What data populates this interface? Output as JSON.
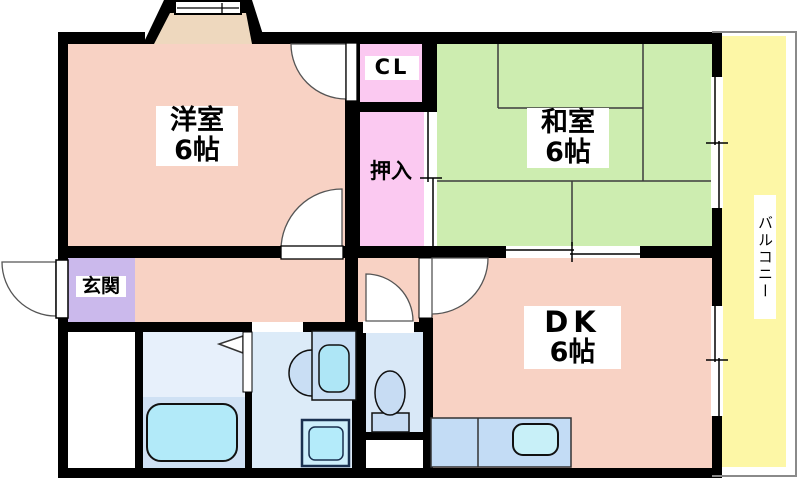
{
  "plan_title": "1DK apartment floor plan",
  "rooms": {
    "western": {
      "name": "洋室",
      "size": "6帖"
    },
    "japanese": {
      "name": "和室",
      "size": "6帖"
    },
    "dk": {
      "name": "DK",
      "size": "6帖"
    },
    "closet": {
      "label": "CL"
    },
    "oshiire": {
      "label": "押入"
    },
    "entrance": {
      "label": "玄関"
    },
    "balcony": {
      "label": "バルコニー"
    }
  },
  "fixtures": [
    "bathtub-icon",
    "toilet-icon",
    "washbasin-icon",
    "washing-machine-pan-icon",
    "kitchen-sink-icon",
    "bay-window-icon",
    "sliding-window-icon",
    "door-swing-icon"
  ],
  "colors": {
    "wall": "#000000",
    "room_salmon": "#f8d2c4",
    "closet_pink": "#fbc9f1",
    "tatami_green": "#cdedb0",
    "balcony_yellow": "#fdf7a6",
    "entrance_lavender": "#cbb9ec",
    "bath_floor": "#e7f0fb",
    "bath_unit": "#cfe1f4",
    "washroom_blue": "#dcebf8",
    "toilet_blue": "#d9e8f7",
    "fixture_blue": "#c9def4",
    "water_cyan": "#aee8f8",
    "bay_window_tan": "#eed8be",
    "balcony_outline_gray": "#8a8a8a"
  }
}
